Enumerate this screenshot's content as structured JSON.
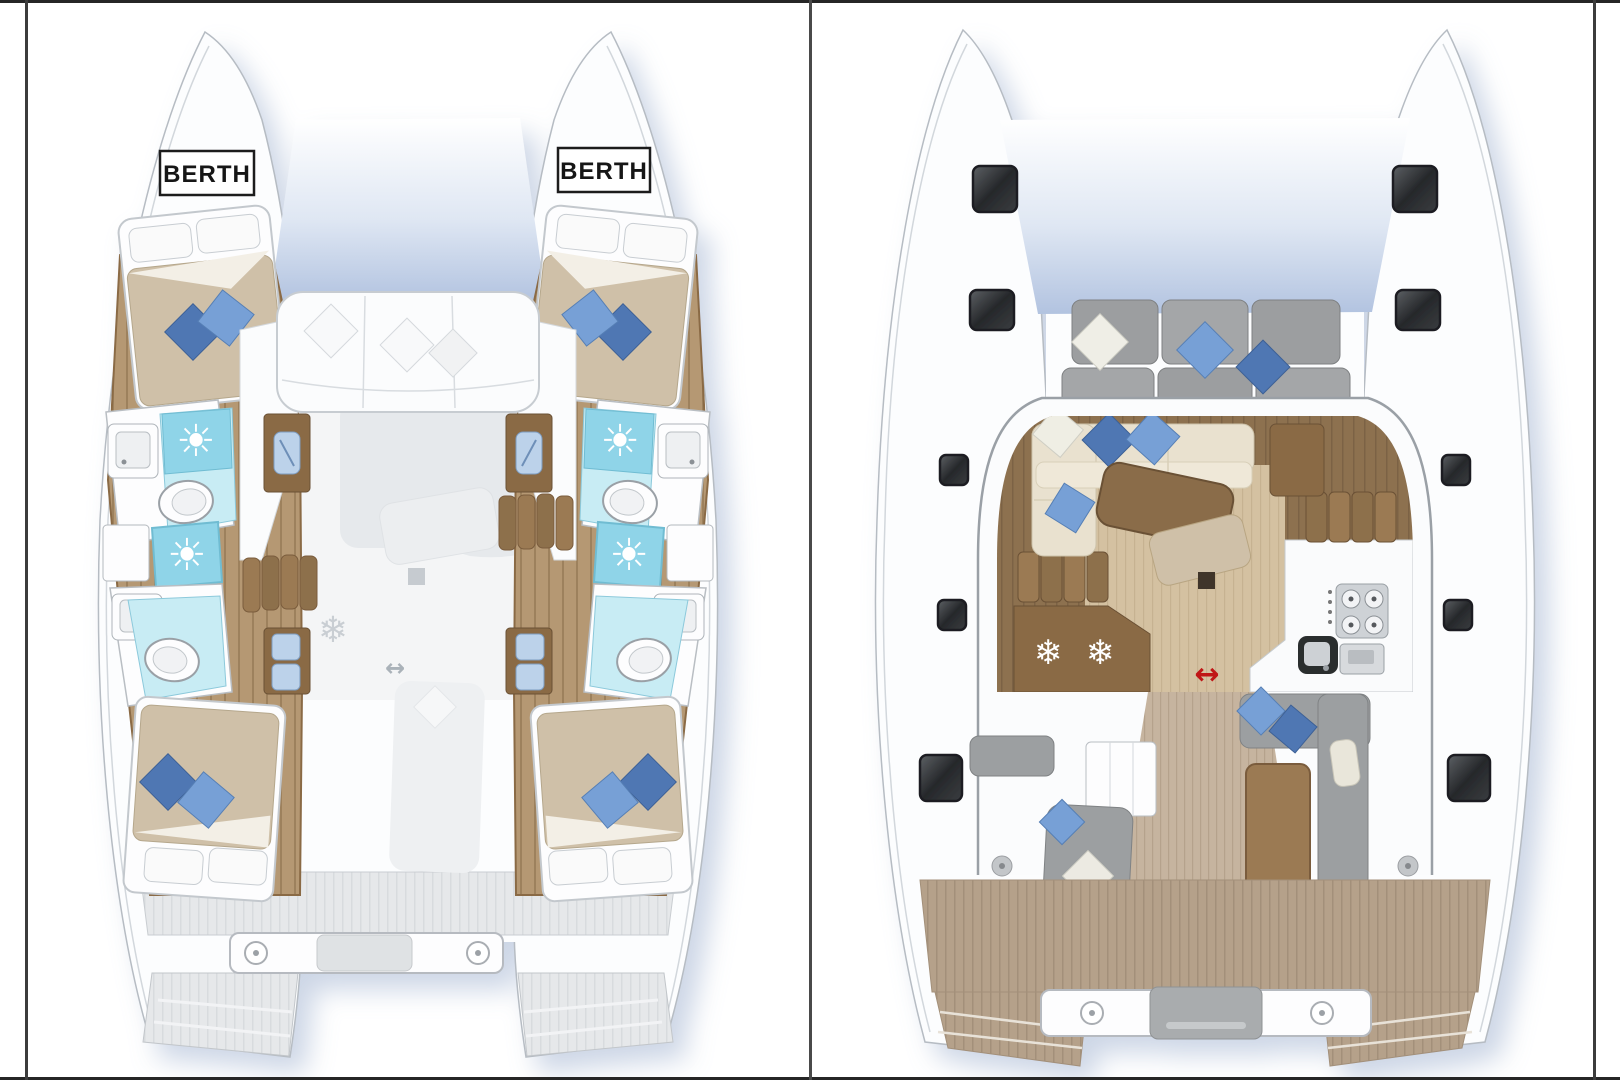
{
  "labels": {
    "berth_port": "BERTH",
    "berth_starboard": "BERTH"
  },
  "icons": {
    "sun": "☀",
    "snowflake": "❄",
    "slide_arrow": "↔"
  },
  "colors": {
    "hull_white": "#fcfdfe",
    "outline_gray": "#a6adb5",
    "wood_floor": "#b59873",
    "wood_dark": "#8a6a45",
    "bed_tan": "#cfc0a8",
    "pillow_blue": "#77a0d6",
    "pillow_blue_dark": "#4f77b3",
    "pillow_white": "#f6f7f8",
    "bath_blue": "#8fd4e8",
    "bath_blue_light": "#c8ecf4",
    "sink_blue": "#bcd2ea",
    "deck_gray": "#e6e8ea",
    "seat_gray": "#9c9fa1",
    "ghost_gray": "#e8ebee",
    "hatch_dark": "#2b2d30",
    "arrow_red": "#c01414",
    "arrow_ghost": "#aab2b9",
    "snowflake_white": "#ffffff",
    "snowflake_ghost": "#c9ced3",
    "salon_wood_dark": "#8d7150",
    "salon_floor_tan": "#d4c1a1",
    "sofa_cream": "#e9e1cf",
    "cockpit_teak": "#b5a18a",
    "table_brown": "#9b7a52",
    "shadow_blue": "#8fa4c8"
  }
}
